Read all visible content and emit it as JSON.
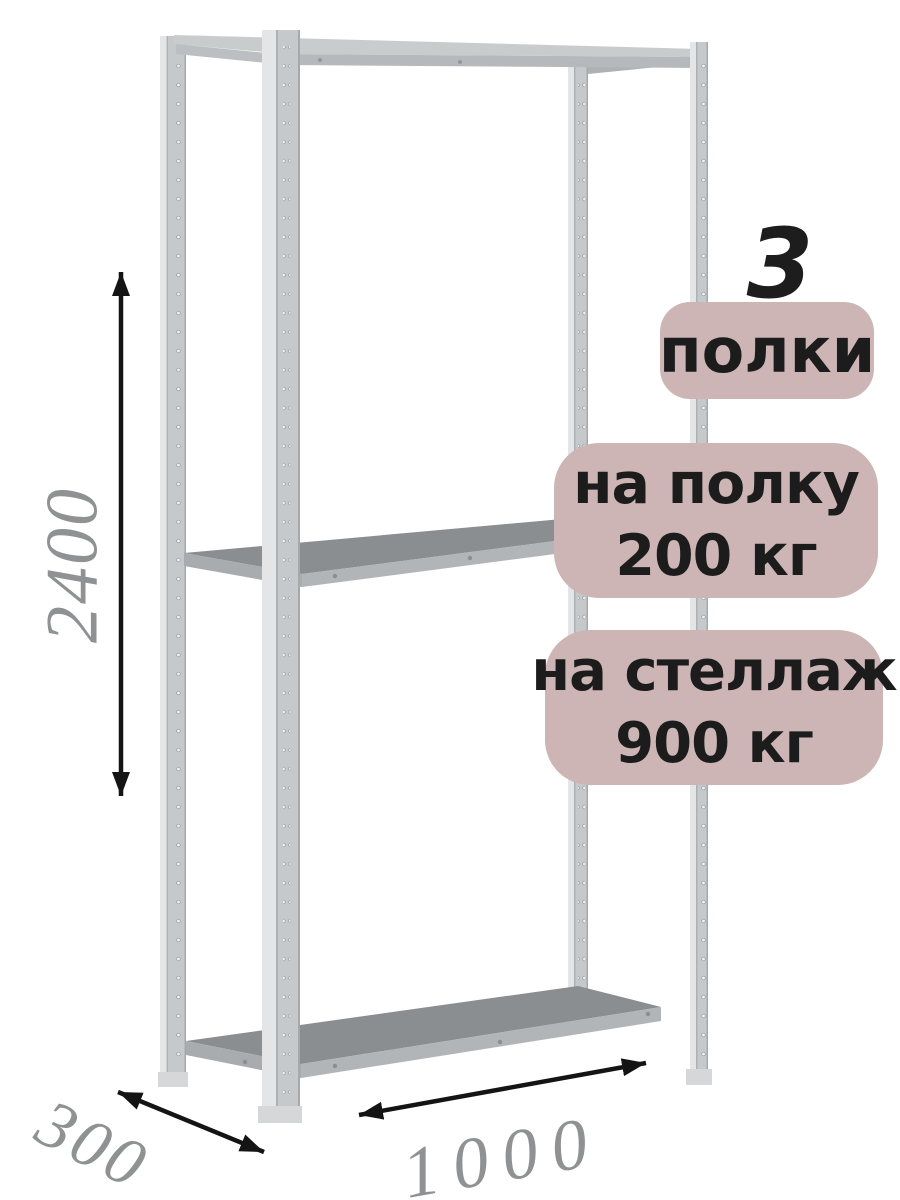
{
  "badges": {
    "background_color": "#cdb5b6",
    "text_color": "#1c1c1c",
    "shelf_count_number": "3",
    "shelf_count_label": "полки",
    "shelf_load_line1": "на полку",
    "shelf_load_line2": "200 кг",
    "rack_load_line1": "на стеллаж",
    "rack_load_line2": "900 кг"
  },
  "dimensions": {
    "height_mm": "2400",
    "depth_mm": "300",
    "width_mm": "1000",
    "label_color": "#8f9193",
    "arrow_color": "#141414"
  },
  "illustration": {
    "post_color": "#c6c9cb",
    "post_highlight_color": "#e3e5e6",
    "shelf_top_color": "#8a8e90",
    "shelf_face_color": "#b2b5b7",
    "top_shelf_color": "#c9cccd"
  }
}
